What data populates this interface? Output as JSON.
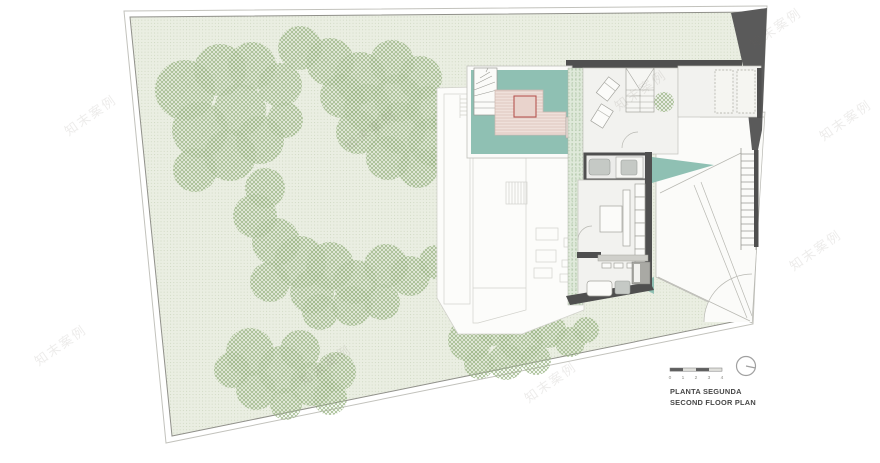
{
  "title_block": {
    "line1": "PLANTA SEGUNDA",
    "line2": "SECOND FLOOR PLAN"
  },
  "scale_bar": {
    "labels": [
      "0",
      "1",
      "2",
      "3",
      "4"
    ]
  },
  "north_indicator": {
    "icon": "north-circle-icon"
  },
  "watermark": {
    "text": "知末案例"
  },
  "colors": {
    "ground": "#eaeee2",
    "ground_dot": "#cbd5bd",
    "tree": "#9cb687",
    "pool": "#8fc0b3",
    "deck": "#efe0da",
    "deck_stripe": "#dbc2ba",
    "accent_red": "#b65551",
    "wall": "#4f4f4f",
    "wedge": "#5a5a5a",
    "floor": "#f2f2ef",
    "line": "#b8b8b2",
    "ghost_line": "#d2d2cc",
    "fixture": "#c5c9c5",
    "band": "#dfe9da",
    "band_dot": "#a9c2a0",
    "title_text": "#474747",
    "scale_text": "#8a8a86"
  }
}
